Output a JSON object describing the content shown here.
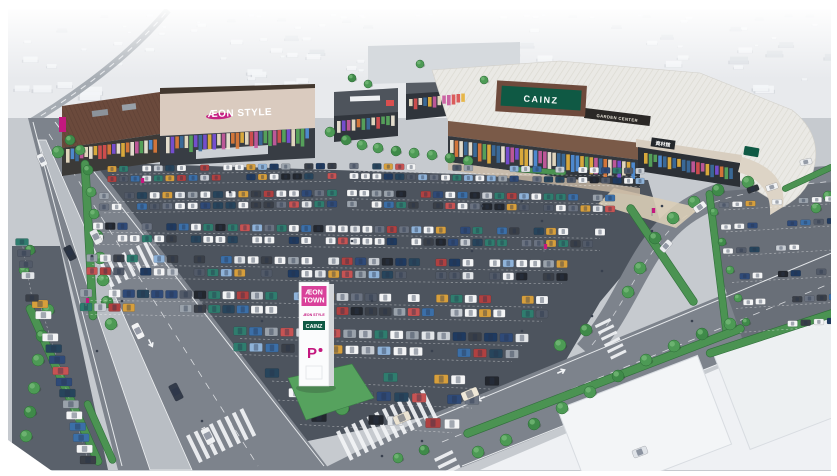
{
  "signs": {
    "aeon_building": "ÆON STYLE",
    "cainz_building": "CAINZ",
    "garden_center": "GARDEN CENTER",
    "materials_hall": "資材館",
    "pylon": {
      "line1": "ÆON",
      "line2": "TOWN",
      "line3": "ÆON STYLE",
      "line4": "CAINZ",
      "parking": "P"
    }
  },
  "colors": {
    "aeon_magenta": "#c4187f",
    "pylon_pink": "#d9419a",
    "cainz_green": "#0f5944",
    "garden_band_dark": "#2b2826",
    "building_brown": "#6e4a3c",
    "facade_beige": "#dacbbf",
    "roof_white": "#eae9e5",
    "lot_asphalt": "#4d545e",
    "road_gray": "#7d838c",
    "median_gray": "#b9bec4",
    "sidewalk_gray": "#c6cacf",
    "massing_white": "#eff1f4",
    "grass_green": "#4d9a55"
  },
  "scene": {
    "car_palette": [
      "#f4f5f6",
      "#f4f5f6",
      "#f4f5f6",
      "#f4f5f6",
      "#e3e6e9",
      "#c9ced4",
      "#9aa2ab",
      "#6a7280",
      "#525a68",
      "#2f4a78",
      "#3b6fa8",
      "#1f3a60",
      "#27455c",
      "#b04040",
      "#c75353",
      "#2f7d6e",
      "#d79f3c",
      "#23272e",
      "#3a3f47",
      "#8fb3d9"
    ],
    "panel_palette": [
      "#d94f4f",
      "#e6b23c",
      "#4f8fd9",
      "#58a85c",
      "#c85a9e",
      "#e07b39",
      "#f2ead9",
      "#3c6e9e",
      "#efe3c8",
      "#7a4fd9"
    ],
    "parking_rows": [
      [
        112,
        169,
        332,
        166,
        9,
        6,
        0.82
      ],
      [
        354,
        166,
        640,
        171,
        9,
        6,
        0.82
      ],
      [
        112,
        179,
        332,
        176,
        9,
        6,
        0.82
      ],
      [
        354,
        176,
        640,
        181,
        9,
        6,
        0.82
      ],
      [
        104,
        196,
        332,
        193,
        10,
        6.5,
        0.84
      ],
      [
        352,
        193,
        610,
        198,
        10,
        6.5,
        0.84
      ],
      [
        104,
        207,
        332,
        204,
        10,
        6.5,
        0.84
      ],
      [
        352,
        204,
        610,
        209,
        10,
        6.5,
        0.84
      ],
      [
        98,
        226,
        600,
        232,
        10,
        7,
        0.85
      ],
      [
        98,
        238,
        600,
        244,
        10,
        7,
        0.85
      ],
      [
        92,
        258,
        562,
        264,
        11,
        7.5,
        0.8
      ],
      [
        92,
        271,
        562,
        277,
        11,
        7.5,
        0.8
      ],
      [
        86,
        293,
        542,
        300,
        12,
        8,
        0.78
      ],
      [
        86,
        307,
        542,
        314,
        12,
        8,
        0.78
      ],
      [
        240,
        331,
        522,
        338,
        13,
        8.5,
        0.75
      ],
      [
        240,
        347,
        512,
        354,
        13,
        8.5,
        0.72
      ],
      [
        272,
        373,
        492,
        381,
        14,
        9,
        0.7
      ],
      [
        278,
        392,
        472,
        400,
        14,
        9,
        0.62
      ],
      [
        300,
        416,
        452,
        424,
        15,
        9.5,
        0.55
      ],
      [
        40,
        304,
        88,
        460,
        16,
        8,
        0.85
      ],
      [
        22,
        242,
        32,
        298,
        13,
        7,
        0.8
      ],
      [
        724,
        205,
        830,
        199,
        10,
        5.5,
        0.8
      ],
      [
        726,
        227,
        832,
        221,
        10,
        5.5,
        0.75
      ],
      [
        728,
        251,
        834,
        245,
        10,
        5.5,
        0.7
      ],
      [
        732,
        277,
        834,
        271,
        10,
        6,
        0.68
      ],
      [
        736,
        303,
        834,
        297,
        10,
        6,
        0.62
      ],
      [
        740,
        327,
        832,
        321,
        10,
        6,
        0.55
      ]
    ],
    "road_cars": [
      [
        42,
        160,
        13,
        7,
        63,
        "#eef0f2"
      ],
      [
        70,
        253,
        15,
        8,
        63,
        "#2b3340"
      ],
      [
        96,
        237,
        15,
        8,
        63,
        "#e8eaec"
      ],
      [
        138,
        331,
        16,
        8,
        63,
        "#f2f3f4"
      ],
      [
        176,
        392,
        17,
        9,
        63,
        "#333b4a"
      ],
      [
        208,
        436,
        17,
        9,
        63,
        "#eef0f2"
      ],
      [
        402,
        418,
        17,
        9,
        -23,
        "#ece4d2"
      ],
      [
        470,
        394,
        17,
        9,
        -23,
        "#efe8d8"
      ],
      [
        700,
        207,
        13,
        7,
        -35,
        "#f1f2f3"
      ],
      [
        666,
        246,
        13,
        7,
        -48,
        "#e9ebee"
      ],
      [
        753,
        189,
        12,
        6,
        -20,
        "#2b3138"
      ],
      [
        772,
        187,
        12,
        6,
        -18,
        "#f3f4f5"
      ],
      [
        806,
        162,
        12,
        6,
        -12,
        "#eceef0"
      ],
      [
        640,
        452,
        15,
        8,
        -21,
        "#dfe3e8"
      ]
    ],
    "trees": [
      [
        70,
        140,
        5
      ],
      [
        80,
        150,
        5
      ],
      [
        58,
        152,
        6
      ],
      [
        88,
        170,
        5
      ],
      [
        91,
        192,
        5
      ],
      [
        94,
        214,
        5
      ],
      [
        97,
        236,
        6
      ],
      [
        100,
        258,
        6
      ],
      [
        103,
        280,
        6
      ],
      [
        107,
        302,
        6
      ],
      [
        111,
        324,
        6
      ],
      [
        330,
        132,
        5
      ],
      [
        346,
        140,
        5
      ],
      [
        362,
        145,
        5
      ],
      [
        378,
        148,
        5
      ],
      [
        396,
        151,
        5
      ],
      [
        414,
        153,
        5
      ],
      [
        432,
        155,
        5
      ],
      [
        450,
        158,
        5
      ],
      [
        468,
        161,
        5
      ],
      [
        484,
        80,
        4
      ],
      [
        352,
        78,
        4
      ],
      [
        368,
        84,
        4
      ],
      [
        420,
        64,
        4
      ],
      [
        322,
        398,
        8
      ],
      [
        342,
        408,
        7
      ],
      [
        560,
        345,
        6
      ],
      [
        586,
        330,
        6
      ],
      [
        640,
        268,
        6
      ],
      [
        628,
        292,
        6
      ],
      [
        655,
        238,
        6
      ],
      [
        673,
        218,
        6
      ],
      [
        694,
        202,
        6
      ],
      [
        718,
        190,
        6
      ],
      [
        748,
        182,
        6
      ],
      [
        714,
        212,
        4
      ],
      [
        722,
        242,
        4
      ],
      [
        730,
        270,
        4
      ],
      [
        738,
        298,
        4
      ],
      [
        746,
        322,
        4
      ],
      [
        478,
        452,
        6
      ],
      [
        506,
        440,
        6
      ],
      [
        534,
        424,
        6
      ],
      [
        562,
        408,
        6
      ],
      [
        590,
        392,
        6
      ],
      [
        618,
        376,
        6
      ],
      [
        646,
        360,
        6
      ],
      [
        674,
        346,
        6
      ],
      [
        702,
        334,
        6
      ],
      [
        730,
        324,
        6
      ],
      [
        398,
        458,
        5
      ],
      [
        424,
        450,
        5
      ],
      [
        816,
        208,
        5
      ],
      [
        828,
        196,
        5
      ],
      [
        30,
        250,
        5
      ],
      [
        24,
        270,
        5
      ],
      [
        48,
        310,
        6
      ],
      [
        42,
        336,
        6
      ],
      [
        38,
        360,
        6
      ],
      [
        34,
        388,
        6
      ],
      [
        30,
        412,
        6
      ],
      [
        26,
        436,
        6
      ]
    ],
    "hedges": [
      [
        89,
        240,
        160,
        8,
        87
      ],
      [
        64,
        385,
        175,
        8,
        66
      ],
      [
        100,
        432,
        68,
        7,
        66
      ],
      [
        662,
        255,
        120,
        8,
        56
      ],
      [
        718,
        264,
        148,
        7,
        83
      ],
      [
        604,
        381,
        300,
        8,
        -21
      ],
      [
        772,
        333,
        138,
        8,
        -18
      ],
      [
        540,
        171,
        52,
        5,
        4
      ],
      [
        808,
        178,
        56,
        6,
        -25
      ]
    ],
    "crosswalks": [
      [
        186,
        436,
        8,
        30,
        4,
        4.5,
        -26
      ],
      [
        336,
        432,
        12,
        32,
        4,
        4.5,
        -26
      ],
      [
        100,
        264,
        7,
        26,
        3.5,
        4.5,
        -26
      ],
      [
        610,
        318,
        6,
        17,
        3,
        4,
        64
      ],
      [
        452,
        450,
        5,
        20,
        3.5,
        4.5,
        64
      ]
    ],
    "storefronts": [
      [
        66,
        149,
        158,
        139,
        15
      ],
      [
        166,
        137,
        310,
        128,
        18
      ],
      [
        337,
        121,
        396,
        115,
        13
      ],
      [
        409,
        99,
        466,
        93,
        12
      ],
      [
        450,
        140,
        636,
        163,
        19
      ],
      [
        644,
        153,
        734,
        169,
        13
      ]
    ],
    "people": [
      [
        230,
        192
      ],
      [
        300,
        231
      ],
      [
        262,
        321
      ],
      [
        372,
        301
      ],
      [
        432,
        351
      ],
      [
        522,
        331
      ],
      [
        602,
        271
      ],
      [
        652,
        231
      ],
      [
        202,
        421
      ],
      [
        122,
        301
      ],
      [
        97,
        351
      ],
      [
        522,
        201
      ],
      [
        562,
        181
      ],
      [
        472,
        251
      ],
      [
        662,
        206
      ],
      [
        692,
        321
      ],
      [
        422,
        441
      ],
      [
        382,
        456
      ],
      [
        92,
        256
      ],
      [
        542,
        221
      ],
      [
        482,
        206
      ],
      [
        352,
        241
      ],
      [
        312,
        196
      ],
      [
        592,
        316
      ]
    ],
    "flags": [
      [
        141,
        186
      ],
      [
        544,
        252
      ],
      [
        652,
        216
      ],
      [
        86,
        306
      ]
    ],
    "arrows": [
      [
        150,
        342,
        153
      ],
      [
        482,
        398,
        246
      ],
      [
        560,
        372,
        66
      ],
      [
        800,
        167,
        96
      ]
    ]
  }
}
